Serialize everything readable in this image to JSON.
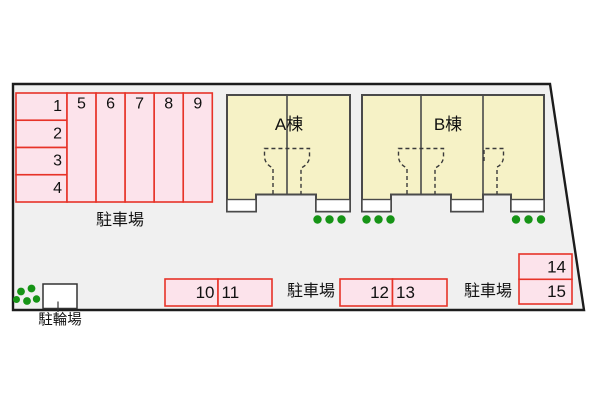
{
  "colors": {
    "site_fill": "#f0f0f0",
    "site_border": "#1c1c1c",
    "parking_fill": "#fce3eb",
    "parking_border": "#e73328",
    "building_fill": "#f6f2c6",
    "building_border": "#4a4a4a",
    "plant_green": "#169416",
    "text_color": "#111111"
  },
  "parking_main": {
    "area_label": "駐車場",
    "spaces": [
      "1",
      "2",
      "3",
      "4",
      "5",
      "6",
      "7",
      "8",
      "9"
    ]
  },
  "buildings": [
    {
      "label": "A棟"
    },
    {
      "label": "B棟"
    }
  ],
  "parking_south_west": {
    "area_label": "駐車場",
    "spaces": [
      "10",
      "11"
    ]
  },
  "parking_south_east": {
    "area_label": "駐車場",
    "spaces": [
      "12",
      "13"
    ]
  },
  "parking_east": {
    "spaces": [
      "14",
      "15"
    ]
  },
  "bicycle_parking": {
    "label": "駐輪場"
  }
}
